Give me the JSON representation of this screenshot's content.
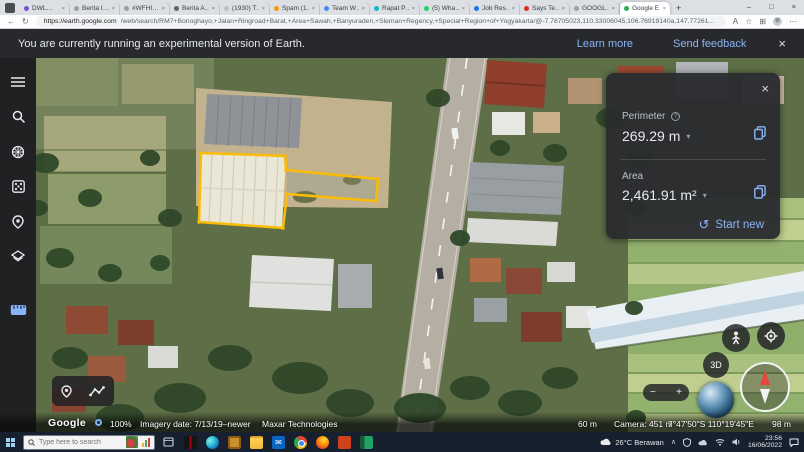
{
  "colors": {
    "measure_accent": "#fbbc04",
    "link_blue": "#8ab4f8"
  },
  "browser": {
    "tabs": [
      {
        "label": "DWL…",
        "color": "#7b52c9"
      },
      {
        "label": "Berita I…",
        "color": "#9aa0a6"
      },
      {
        "label": "#WFHI…",
        "color": "#9aa0a6"
      },
      {
        "label": "Berita A…",
        "color": "#5f6368"
      },
      {
        "label": "(1930) T…",
        "color": "#bdc1c6"
      },
      {
        "label": "Spam (1…",
        "color": "#f29900"
      },
      {
        "label": "Team W…",
        "color": "#4285f4"
      },
      {
        "label": "Rapat P…",
        "color": "#12b5cb"
      },
      {
        "label": "(5) Wha…",
        "color": "#25d366"
      },
      {
        "label": "Job Res…",
        "color": "#1a73e8"
      },
      {
        "label": "Says Te…",
        "color": "#d93025"
      },
      {
        "label": "GOOGL…",
        "color": "#9aa0a6"
      },
      {
        "label": "Google E…",
        "color": "#34a853",
        "active": true
      }
    ],
    "new_tab_label": "+",
    "controls": {
      "minimize": "–",
      "maximize": "□",
      "close": "×"
    },
    "nav": {
      "back": "←",
      "refresh": "↻",
      "read_aloud": "A",
      "favorite": "☆",
      "collections": "⊞",
      "more": "⋯"
    },
    "url_host": "https://earth.google.com",
    "url_path": "/web/search/RM7+Bonoghayo,+Jalan+Ringroad+Barat,+Area+Sawah,+Banyuraden,+Sleman+Regency,+Special+Region+of+Yogyakarta/@-7.78705023,110.33006045,106.76919140a,147.77261114d,35y,0h,0t,0r"
  },
  "notice": {
    "message": "You are currently running an experimental version of Earth.",
    "learn_more": "Learn more",
    "send_feedback": "Send feedback",
    "close": "×"
  },
  "measure_panel": {
    "close": "×",
    "perimeter_label": "Perimeter",
    "perimeter_help": "?",
    "perimeter_value": "269.29 m",
    "dropdown": "▾",
    "area_label": "Area",
    "area_value": "2,461.91 m²",
    "start_new_icon": "↺",
    "start_new": "Start new"
  },
  "map_controls": {
    "threed": "3D",
    "zoom_in": "+",
    "zoom_out": "−"
  },
  "status_bar": {
    "brand": "Google",
    "zoom_percent": "100%",
    "imagery_date": "Imagery date: 7/13/19–newer",
    "attribution": "Maxar Technologies",
    "scale": "60 m",
    "camera": "Camera: 451 m",
    "coordinates": "7°47'50\"S 110°19'45\"E",
    "elevation": "98 m"
  },
  "taskbar": {
    "search_placeholder": "Type here to search",
    "weather": "26°C Berawan",
    "tray_expand": "∧",
    "time": "23:56",
    "date": "16/06/2022"
  }
}
